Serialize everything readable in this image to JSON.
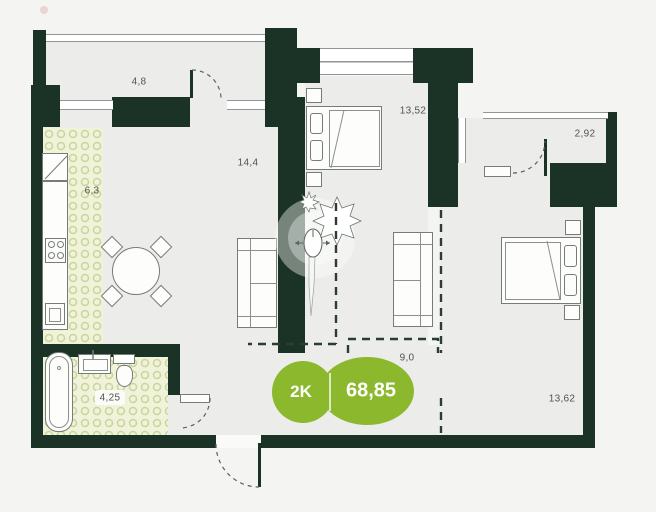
{
  "plan": {
    "badge": {
      "rooms_label": "2K",
      "area_label": "68,85",
      "color": "#8cb82e",
      "text_color": "#ffffff"
    },
    "rooms": [
      {
        "id": "balcony-top",
        "area": "4,8"
      },
      {
        "id": "kitchen",
        "area": "6,3"
      },
      {
        "id": "living-room",
        "area": "14,4"
      },
      {
        "id": "bedroom-1",
        "area": "13,52"
      },
      {
        "id": "balcony-right",
        "area": "2,92"
      },
      {
        "id": "hallway",
        "area": "9,0"
      },
      {
        "id": "bedroom-2",
        "area": "13,62"
      },
      {
        "id": "bathroom",
        "area": "4,25"
      }
    ],
    "colors": {
      "wall": "#1b3326",
      "floor": "#ecedea",
      "background": "#f4f4f2",
      "tile_background": "#f0f3da",
      "tile_pattern": "#c9d59c",
      "badge_green": "#8cb82e",
      "label_text": "#50544f",
      "outline_gray": "#8f9693"
    }
  }
}
